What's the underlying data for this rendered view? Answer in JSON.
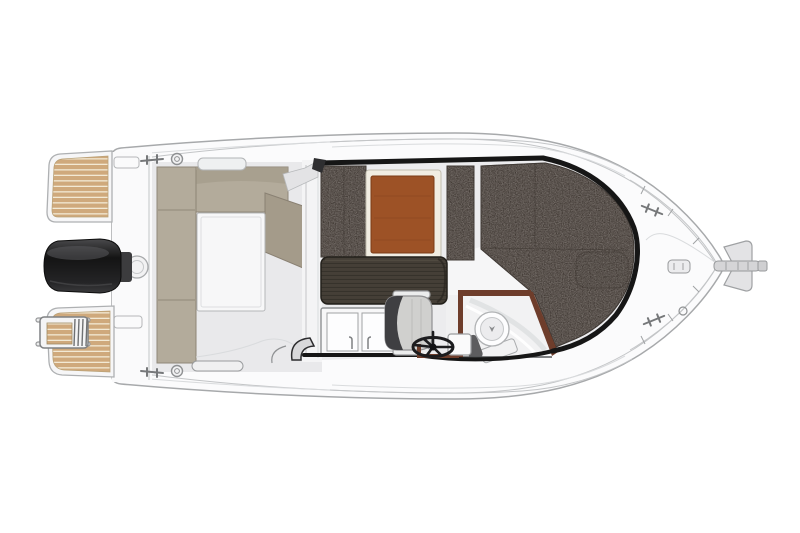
{
  "meta": {
    "title": "Motorboat deck plan — overhead top view",
    "view": "top-down floor plan illustration",
    "bow_direction": "right",
    "stern_direction": "left",
    "background": "white"
  },
  "colors": {
    "hull": "#fbfbfc",
    "hull_line": "#a7a9ab",
    "deck": "#e9e9eb",
    "deck_line": "#c3c5c7",
    "outline": "#161616",
    "teak": "#cfa97c",
    "teak_gap": "#f2e9d4",
    "bench": "#b3ab9b",
    "bench_dark": "#a49b8a",
    "bench_seam": "#8e8576",
    "cushion": "#928b86",
    "cushion_seam": "#55504b",
    "table_wood": "#9d5226",
    "table_border": "#f1ede2",
    "counter": "#453f37",
    "counter_grain": "#2e2923",
    "trim": "#6e3d2b",
    "seat": "#d0d0ce",
    "seat_dark": "#3f3f42",
    "chrome": "#e2e2e3",
    "wheel": "#1c1c1e",
    "motor": "#141414",
    "motor_hl": "#58585a",
    "floor_white": "#f7f7f8",
    "white": "#ffffff"
  },
  "parts": {
    "hull": "Hull with rub rail",
    "transom": "Transom",
    "swim_platform_port": "Swim platform, port side (teak)",
    "swim_platform_starboard": "Swim platform, starboard side (teak)",
    "boarding_ladder": "Telescopic boarding ladder",
    "outboard_motor": "Outboard engine",
    "engine_bracket": "Engine mounting bracket",
    "stern_fitting": "Transom deck fitting",
    "cockpit": "Aft cockpit",
    "cockpit_bench": "L-shaped cockpit bench seating",
    "cockpit_backrest": "Angled co-pilot backrest panel",
    "cockpit_hatch": "Cockpit floor locker hatch",
    "grab_handle": "Gunwale grab handle",
    "side_pocket": "Gunwale side pocket",
    "bulkhead": "Wheelhouse aft bulkhead with sliding door",
    "wheelhouse": "Wheelhouse interior",
    "dinette_cushions": "Dinette seating cushions",
    "dinette_table": "Dinette table (wood)",
    "galley_counter": "Galley worktop (dark wood)",
    "galley_sink": "Galley sink and stove unit",
    "helm_seat": "Helm seat",
    "steering_wheel": "Steering wheel",
    "dashboard": "Helm console trim",
    "helm_module": "Helm-side locker box",
    "head_compartment": "Head (toilet) compartment",
    "toilet": "Marine toilet",
    "v_berth": "Forward V-berth cushions",
    "entry_step": "Companionway step",
    "bow_deck": "Foredeck",
    "anchor_roller": "Bow roller / anchor fitting",
    "deck_fitting": "Foredeck latch fitting",
    "cleat": "Mooring cleat",
    "rail_ring": "Chromed deck ring"
  }
}
